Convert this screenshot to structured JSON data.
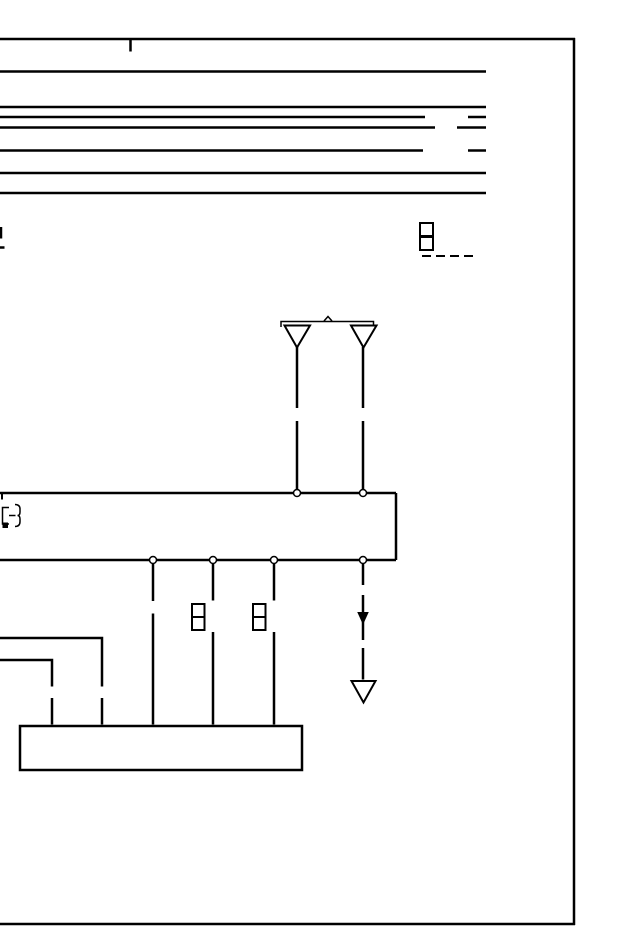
{
  "document": {
    "type": "wiring-diagram-page",
    "title": "",
    "visible_text": [],
    "canvas": {
      "width": 640,
      "height": 950
    },
    "colors": {
      "ink": "#000000",
      "paper": "#ffffff"
    }
  },
  "diagram": {
    "shapes": [
      {
        "type": "line",
        "name": "page-border-top",
        "x1": 0,
        "y1": 39,
        "x2": 575,
        "y2": 39,
        "sw": 2.5
      },
      {
        "type": "line",
        "name": "page-border-right",
        "x1": 574,
        "y1": 38,
        "x2": 574,
        "y2": 925,
        "sw": 2.5
      },
      {
        "type": "line",
        "name": "page-border-bottom",
        "x1": 0,
        "y1": 924,
        "x2": 575,
        "y2": 924,
        "sw": 2.5
      },
      {
        "type": "line",
        "name": "page-top-tick",
        "x1": 130.5,
        "y1": 40,
        "x2": 130.5,
        "y2": 51.5,
        "sw": 2.5
      },
      {
        "type": "line",
        "name": "bus-line-1",
        "x1": 0,
        "y1": 71.5,
        "x2": 486,
        "y2": 71.5,
        "sw": 2.5
      },
      {
        "type": "line",
        "name": "bus-line-2",
        "x1": 0,
        "y1": 107,
        "x2": 486,
        "y2": 107,
        "sw": 2.5
      },
      {
        "type": "line",
        "name": "bus-line-3",
        "x1": 0,
        "y1": 117,
        "x2": 425,
        "y2": 117,
        "sw": 2.5
      },
      {
        "type": "line",
        "name": "bus-line-3-stub",
        "x1": 468,
        "y1": 117,
        "x2": 486,
        "y2": 117,
        "sw": 2.5
      },
      {
        "type": "line",
        "name": "bus-line-4",
        "x1": 0,
        "y1": 127.5,
        "x2": 435,
        "y2": 127.5,
        "sw": 2.5
      },
      {
        "type": "line",
        "name": "bus-line-4-stub",
        "x1": 457,
        "y1": 127.5,
        "x2": 486,
        "y2": 127.5,
        "sw": 2.5
      },
      {
        "type": "line",
        "name": "bus-line-5",
        "x1": 0,
        "y1": 150.5,
        "x2": 423,
        "y2": 150.5,
        "sw": 2.5
      },
      {
        "type": "line",
        "name": "bus-line-5-stub",
        "x1": 468,
        "y1": 150.5,
        "x2": 486,
        "y2": 150.5,
        "sw": 2.5
      },
      {
        "type": "line",
        "name": "bus-line-6",
        "x1": 0,
        "y1": 173,
        "x2": 486,
        "y2": 173,
        "sw": 2.5
      },
      {
        "type": "line",
        "name": "bus-line-7",
        "x1": 0,
        "y1": 193,
        "x2": 486,
        "y2": 193,
        "sw": 2.5
      },
      {
        "type": "line",
        "name": "left-edge-tick-vertical",
        "x1": 1,
        "y1": 227,
        "x2": 1,
        "y2": 238.5,
        "sw": 2.5
      },
      {
        "type": "line",
        "name": "left-edge-tick-horizontal",
        "x1": 0,
        "y1": 247.5,
        "x2": 4.5,
        "y2": 247.5,
        "sw": 2.5
      },
      {
        "type": "rect",
        "name": "connector-a-pin-1",
        "x": 420,
        "y": 223,
        "w": 13,
        "h": 13,
        "sw": 2
      },
      {
        "type": "rect",
        "name": "connector-a-pin-2",
        "x": 420,
        "y": 237,
        "w": 13,
        "h": 13,
        "sw": 2
      },
      {
        "type": "line",
        "name": "connector-a-dashed-lead",
        "x1": 422,
        "y1": 256,
        "x2": 474,
        "y2": 256,
        "sw": 2,
        "dash": "9 5"
      },
      {
        "type": "polyline",
        "name": "antenna-bracket",
        "points": "281,327 281,321.5 373.5,321.5 373.5,327",
        "sw": 1.5
      },
      {
        "type": "polyline",
        "name": "antenna-bracket-caret",
        "points": "324,321 328,316.5 332,321",
        "sw": 1.5
      },
      {
        "type": "polygon",
        "name": "antenna-symbol-left",
        "points": "284.5,325.5 310,325.5 297,347.5",
        "sw": 2,
        "fill": "#ffffff"
      },
      {
        "type": "polygon",
        "name": "antenna-symbol-right",
        "points": "351,325.5 376.5,325.5 363.5,347.5",
        "sw": 2,
        "fill": "#ffffff"
      },
      {
        "type": "line",
        "name": "antenna-lead-left-upper",
        "x1": 297,
        "y1": 347,
        "x2": 297,
        "y2": 408,
        "sw": 2.5
      },
      {
        "type": "line",
        "name": "antenna-lead-left-lower",
        "x1": 297,
        "y1": 421,
        "x2": 297,
        "y2": 489.5,
        "sw": 2.5
      },
      {
        "type": "line",
        "name": "antenna-lead-right-upper",
        "x1": 363,
        "y1": 347,
        "x2": 363,
        "y2": 408,
        "sw": 2.5
      },
      {
        "type": "line",
        "name": "antenna-lead-right-lower",
        "x1": 363,
        "y1": 421,
        "x2": 363,
        "y2": 489.5,
        "sw": 2.5
      },
      {
        "type": "line",
        "name": "unit-box-top",
        "x1": 0,
        "y1": 493,
        "x2": 396,
        "y2": 493,
        "sw": 2.5
      },
      {
        "type": "line",
        "name": "unit-box-right",
        "x1": 396,
        "y1": 493,
        "x2": 396,
        "y2": 560,
        "sw": 2.5
      },
      {
        "type": "line",
        "name": "unit-box-bottom",
        "x1": 0,
        "y1": 560,
        "x2": 396,
        "y2": 560,
        "sw": 2.5
      },
      {
        "type": "line",
        "name": "unit-box-left-tick",
        "x1": 2,
        "y1": 494,
        "x2": 2,
        "y2": 499.5,
        "sw": 2
      },
      {
        "type": "polyline",
        "name": "component-glyph-body",
        "points": "9,507.5 2.5,507.5 2.5,524 9,524",
        "sw": 1.5
      },
      {
        "type": "rect",
        "name": "component-glyph-contact",
        "x": 2.5,
        "y": 522.5,
        "w": 5.5,
        "h": 5.5,
        "fill": "#000000",
        "stroke": "none",
        "sw": 0
      },
      {
        "type": "line",
        "name": "component-glyph-lead",
        "x1": 9,
        "y1": 515.5,
        "x2": 15.5,
        "y2": 515.5,
        "sw": 1.5
      },
      {
        "type": "path",
        "name": "component-glyph-brace",
        "d": "M15,504.5 Q20,504.5 20,509 L20,512 Q20,515.5 17.5,515.5 Q20,515.5 20,519 L20,521.5 Q20,526.5 15,526.5",
        "sw": 1.5
      },
      {
        "type": "circle",
        "name": "antenna-terminal-left",
        "cx": 297,
        "cy": 493,
        "r": 3.5,
        "sw": 1.5,
        "fill": "#ffffff"
      },
      {
        "type": "circle",
        "name": "antenna-terminal-right",
        "cx": 363,
        "cy": 493,
        "r": 3.5,
        "sw": 1.5,
        "fill": "#ffffff"
      },
      {
        "type": "circle",
        "name": "output-terminal-1",
        "cx": 153,
        "cy": 560,
        "r": 3.5,
        "sw": 1.5,
        "fill": "#ffffff"
      },
      {
        "type": "circle",
        "name": "output-terminal-2",
        "cx": 213,
        "cy": 560,
        "r": 3.5,
        "sw": 1.5,
        "fill": "#ffffff"
      },
      {
        "type": "circle",
        "name": "output-terminal-3",
        "cx": 274,
        "cy": 560,
        "r": 3.5,
        "sw": 1.5,
        "fill": "#ffffff"
      },
      {
        "type": "circle",
        "name": "output-terminal-4",
        "cx": 363,
        "cy": 560,
        "r": 3.5,
        "sw": 1.5,
        "fill": "#ffffff"
      },
      {
        "type": "line",
        "name": "wire-1-upper",
        "x1": 153,
        "y1": 564,
        "x2": 153,
        "y2": 601,
        "sw": 2.5
      },
      {
        "type": "line",
        "name": "wire-1-lower",
        "x1": 153,
        "y1": 613.5,
        "x2": 153,
        "y2": 724.5,
        "sw": 2.5
      },
      {
        "type": "line",
        "name": "wire-2-upper",
        "x1": 213,
        "y1": 564,
        "x2": 213,
        "y2": 600.5,
        "sw": 2.5
      },
      {
        "type": "line",
        "name": "wire-2-lower",
        "x1": 213,
        "y1": 632,
        "x2": 213,
        "y2": 724.5,
        "sw": 2.5
      },
      {
        "type": "line",
        "name": "wire-3-upper",
        "x1": 274,
        "y1": 564,
        "x2": 274,
        "y2": 600.5,
        "sw": 2.5
      },
      {
        "type": "line",
        "name": "wire-3-lower",
        "x1": 274,
        "y1": 632,
        "x2": 274,
        "y2": 724.5,
        "sw": 2.5
      },
      {
        "type": "rect",
        "name": "connector-b-pin-1",
        "x": 192,
        "y": 604,
        "w": 12.5,
        "h": 13,
        "sw": 2
      },
      {
        "type": "rect",
        "name": "connector-b-pin-2",
        "x": 192,
        "y": 617,
        "w": 12.5,
        "h": 13,
        "sw": 2
      },
      {
        "type": "rect",
        "name": "connector-c-pin-1",
        "x": 253,
        "y": 604,
        "w": 12.5,
        "h": 13,
        "sw": 2
      },
      {
        "type": "rect",
        "name": "connector-c-pin-2",
        "x": 253,
        "y": 617,
        "w": 12.5,
        "h": 13,
        "sw": 2
      },
      {
        "type": "line",
        "name": "ground-wire-seg-1",
        "x1": 363,
        "y1": 564,
        "x2": 363,
        "y2": 585,
        "sw": 2.5
      },
      {
        "type": "line",
        "name": "ground-wire-seg-2",
        "x1": 363,
        "y1": 595,
        "x2": 363,
        "y2": 640,
        "sw": 2.5
      },
      {
        "type": "polygon",
        "name": "ground-wire-arrowhead",
        "points": "358,612.5 368,612.5 363,623.5",
        "fill": "#000000",
        "sw": 1
      },
      {
        "type": "line",
        "name": "ground-wire-seg-3",
        "x1": 363,
        "y1": 648,
        "x2": 363,
        "y2": 679.5,
        "sw": 2.5
      },
      {
        "type": "polygon",
        "name": "ground-symbol",
        "points": "351.5,681 375.5,681 363.5,702.5",
        "sw": 2,
        "fill": "#ffffff"
      },
      {
        "type": "polyline",
        "name": "branch-wire-a",
        "points": "0,638 102,638 102,686.5",
        "sw": 2.5
      },
      {
        "type": "line",
        "name": "branch-wire-a-lower",
        "x1": 102,
        "y1": 698,
        "x2": 102,
        "y2": 724.5,
        "sw": 2.5
      },
      {
        "type": "polyline",
        "name": "branch-wire-b",
        "points": "0,660 52,660 52,686.5",
        "sw": 2.5
      },
      {
        "type": "line",
        "name": "branch-wire-b-lower",
        "x1": 52,
        "y1": 698,
        "x2": 52,
        "y2": 724.5,
        "sw": 2.5
      },
      {
        "type": "rect",
        "name": "lower-unit-box",
        "x": 20,
        "y": 726,
        "w": 282,
        "h": 44,
        "sw": 2.5,
        "fill": "#ffffff"
      }
    ]
  }
}
